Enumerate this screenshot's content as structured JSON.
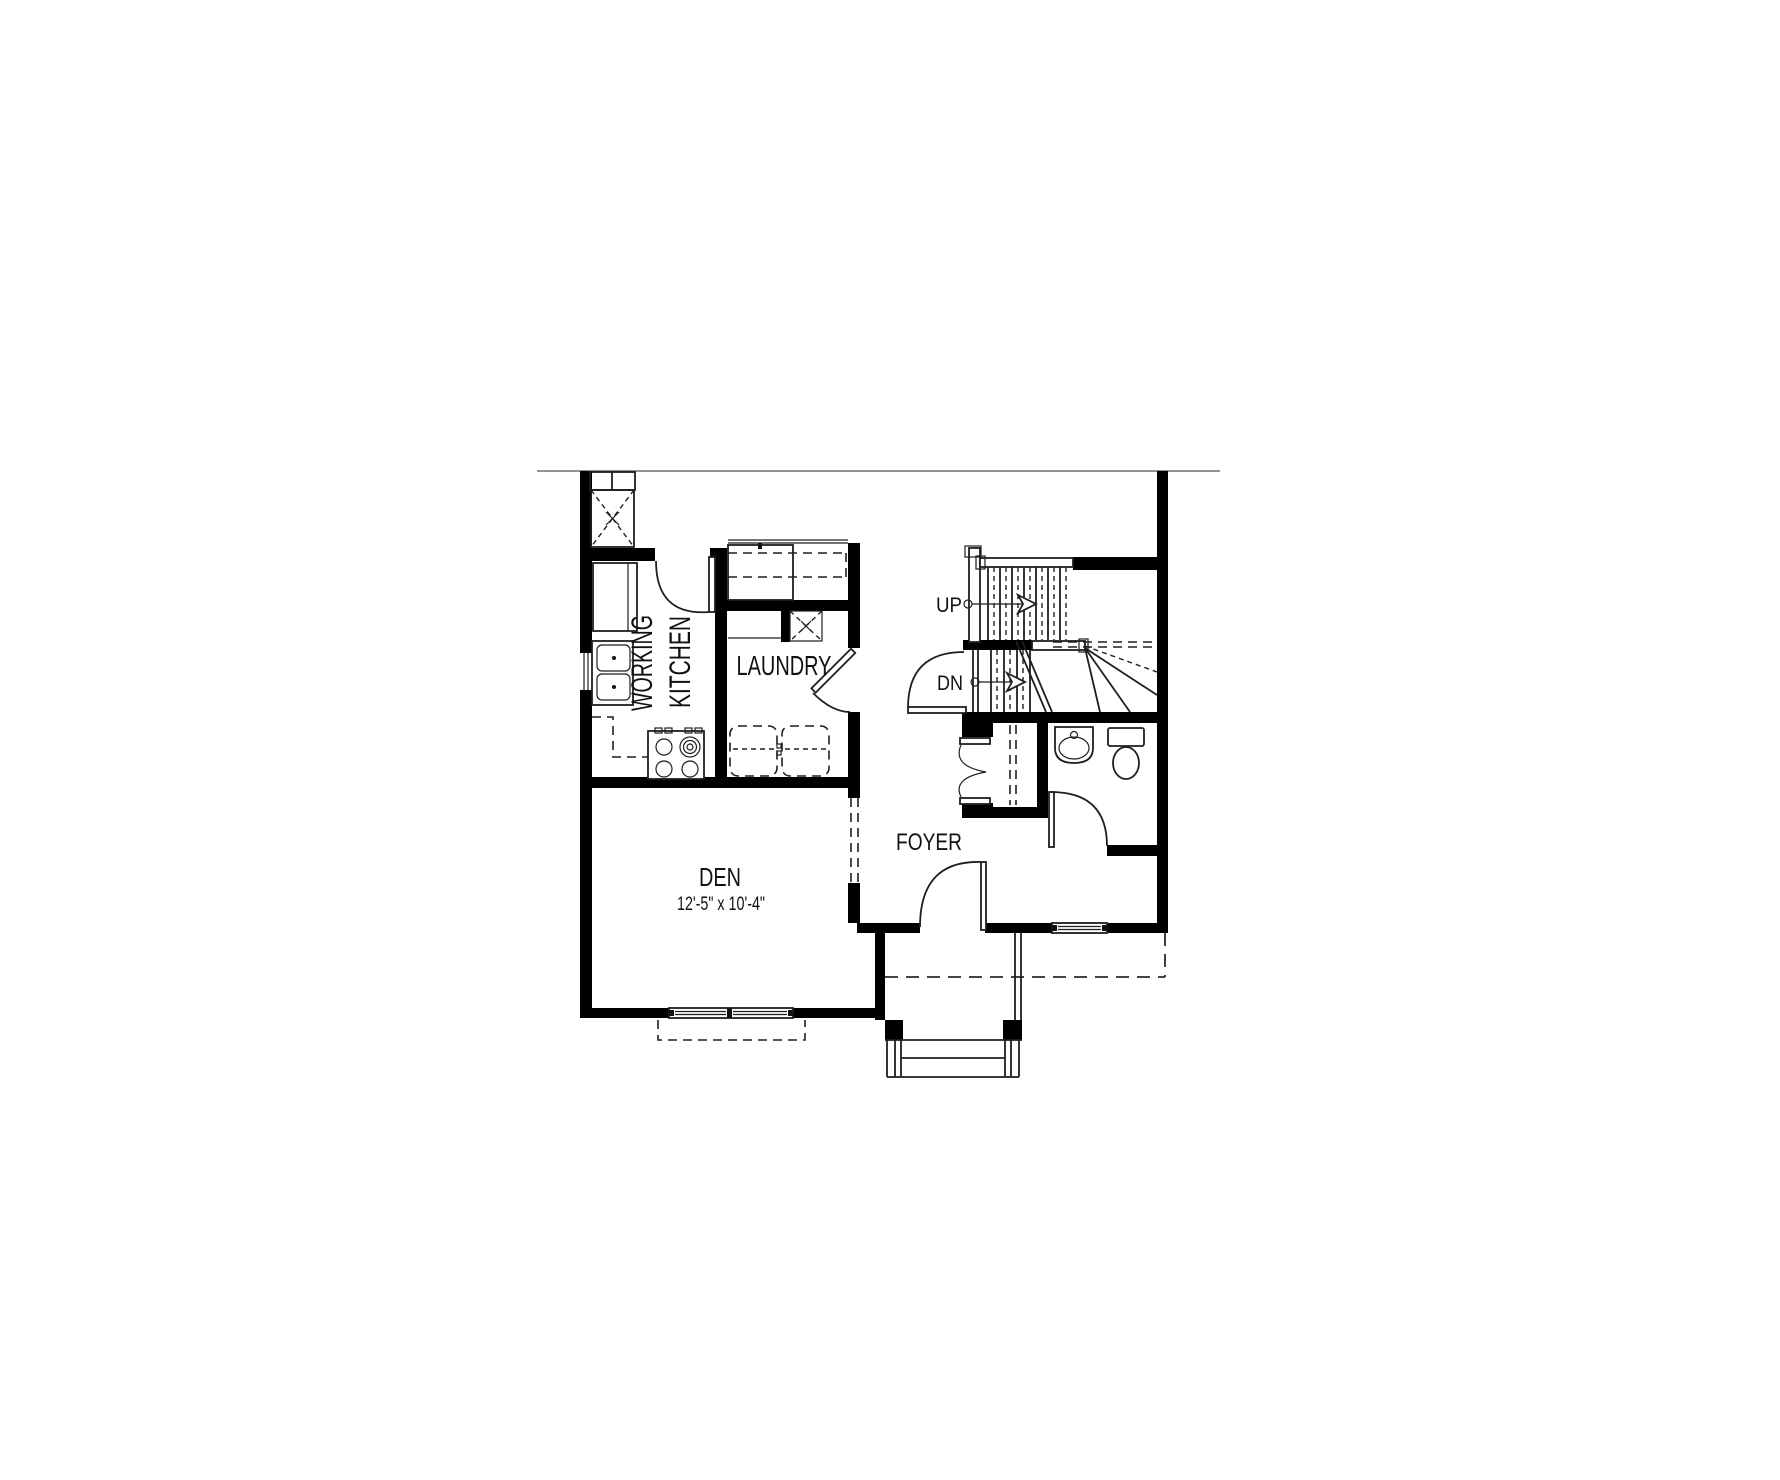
{
  "plan": {
    "rooms": {
      "working_kitchen": {
        "line1": "WORKING",
        "line2": "KITCHEN"
      },
      "laundry": {
        "label": "LAUNDRY"
      },
      "den": {
        "label": "DEN",
        "dimensions": "12'-5\" x 10'-4\""
      },
      "foyer": {
        "label": "FOYER"
      }
    },
    "stairs": {
      "up": "UP",
      "down": "DN"
    },
    "colors": {
      "walls": "#000000",
      "linework": "#1f1f1f",
      "background": "#ffffff",
      "site_line": "#6e6e6e"
    }
  }
}
